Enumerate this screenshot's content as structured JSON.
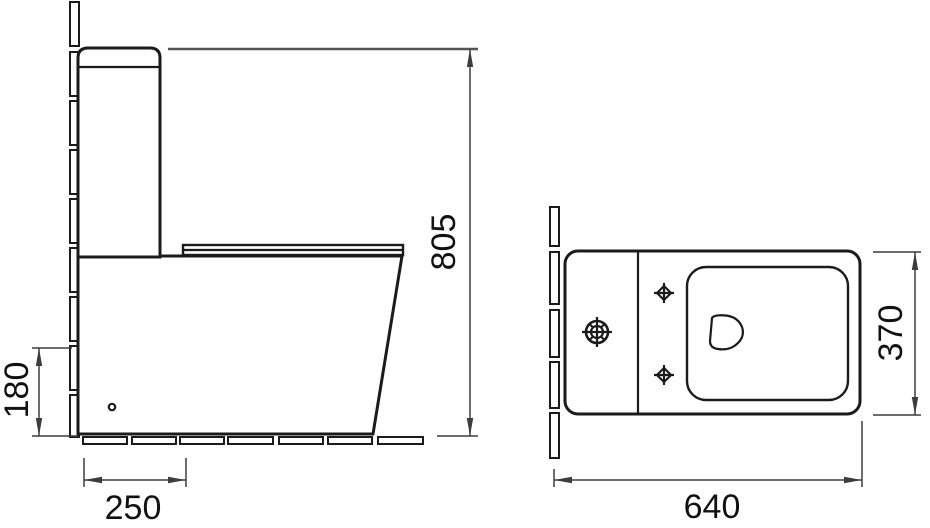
{
  "colors": {
    "line": "#1b1b1b",
    "dim_line": "#3d3d3d",
    "ext_gray": "#555555",
    "text": "#111111",
    "background": "#ffffff"
  },
  "side_view": {
    "dim_height": "805",
    "dim_inlet_height": "180",
    "dim_outlet_offset": "250"
  },
  "top_view": {
    "dim_width": "370",
    "dim_length": "640"
  }
}
